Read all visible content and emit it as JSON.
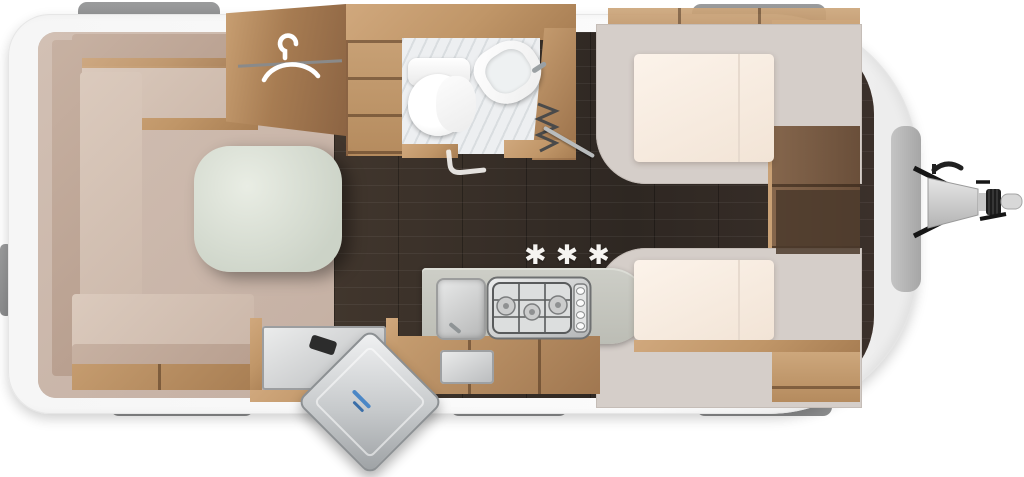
{
  "marker": {
    "winter_symbol": "✱✱✱"
  },
  "icons": {
    "wardrobe": "coat-hanger-icon",
    "washroom": "toilet-icon / washbasin-icon",
    "kitchen": "sink-icon / three-burner-hob-icon",
    "entry": "open-door-icon",
    "front": "tow-hitch-icon",
    "washroom_door": "concertina-door-icon",
    "door_handle_mark": "l-shaped-handle-icon"
  },
  "colors": {
    "shell_white": "#f6f6f6",
    "interior_wall": "#d7cec7",
    "floor_dark_wood": "#352c26",
    "cabinet_wood": "#c09668",
    "upholstery": "#cbb7a9",
    "mattress": "#f8eee3",
    "kitchen_counter": "#c6c7c0",
    "window_grey": "#909192",
    "marker_white": "#f6f4f1"
  }
}
